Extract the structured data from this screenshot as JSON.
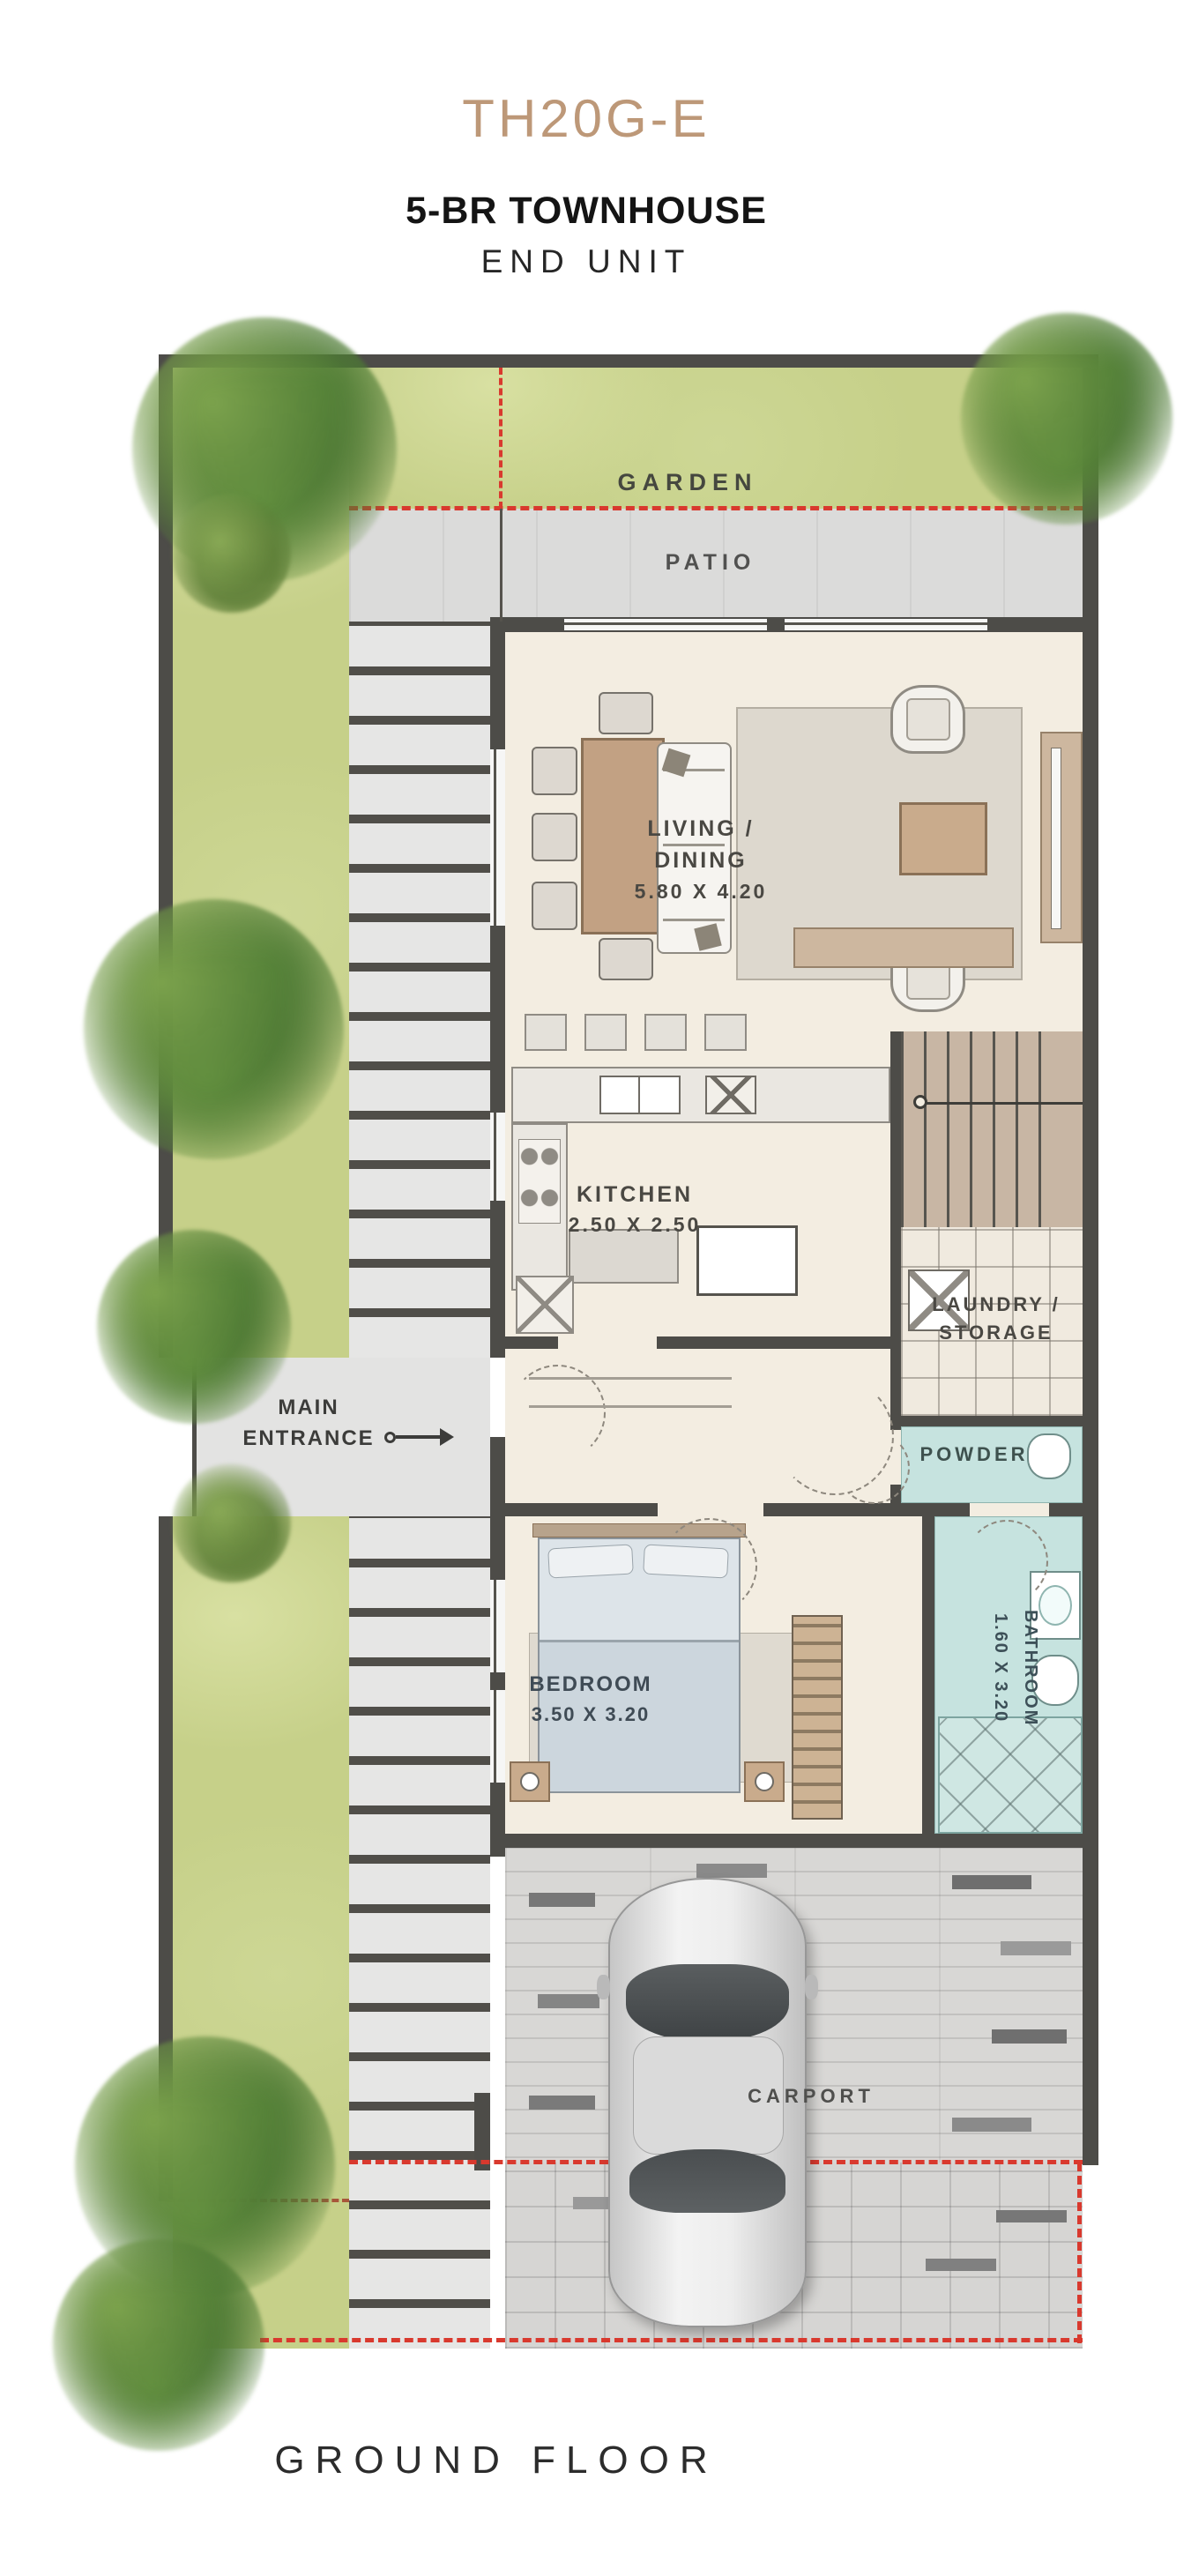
{
  "header": {
    "unit_code": "TH20G-E",
    "unit_type": "5-BR TOWNHOUSE",
    "unit_variant": "END UNIT"
  },
  "footer": {
    "floor_label": "GROUND FLOOR"
  },
  "outdoor": {
    "garden": "GARDEN",
    "patio": "PATIO",
    "carport": "CARPORT",
    "entrance_line1": "MAIN",
    "entrance_line2": "ENTRANCE"
  },
  "rooms": {
    "living": {
      "line1": "LIVING /",
      "line2": "DINING",
      "dims": "5.80 X 4.20"
    },
    "kitchen": {
      "name": "KITCHEN",
      "dims": "2.50 X 2.50"
    },
    "laundry": {
      "line1": "LAUNDRY /",
      "line2": "STORAGE"
    },
    "powder": {
      "name": "POWDER"
    },
    "bedroom": {
      "name": "BEDROOM",
      "dims": "3.50 X 3.20"
    },
    "bathroom": {
      "name": "BATHROOM",
      "dims": "1.60 X 3.20"
    }
  },
  "colors": {
    "accent_tan": "#BD9878",
    "wall": "#4D4C48",
    "lawn": "#C6D089",
    "concrete": "#DCDCDB",
    "floor_cream": "#F3EDE1",
    "teal": "#C6E3DF",
    "wood": "#C9AB8C",
    "boundary_red": "#D9392E",
    "text_dark": "#1C1C1C"
  }
}
